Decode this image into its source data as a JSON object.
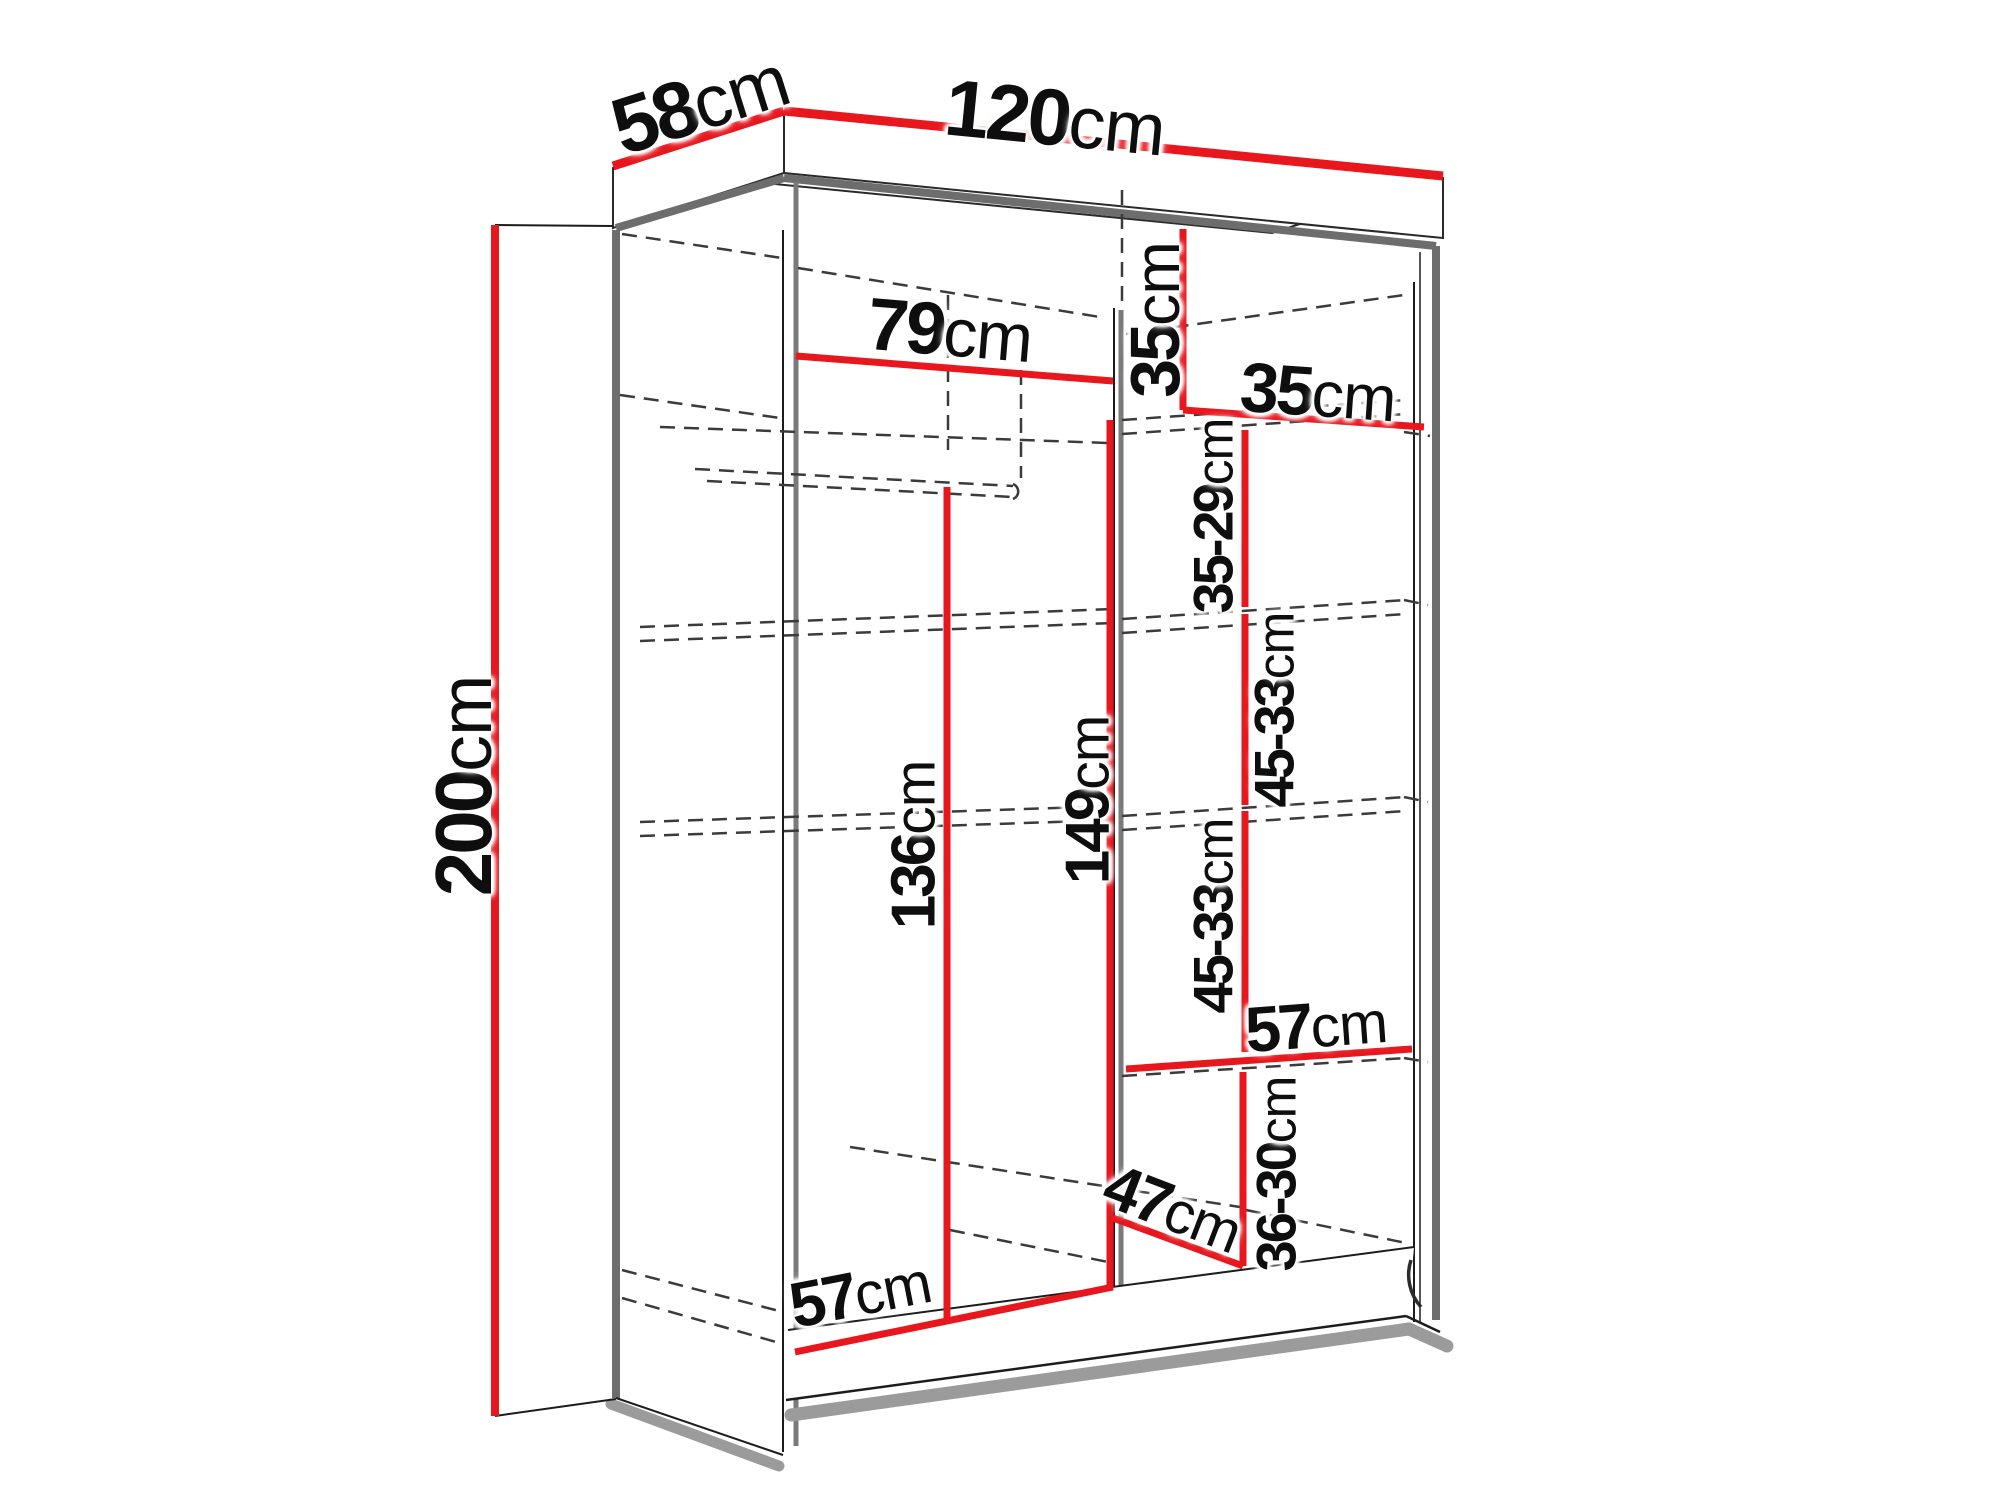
{
  "diagram": {
    "type": "wardrobe-dimension-diagram",
    "unit": "cm",
    "colors": {
      "dimension_line": "#e8161d",
      "structure_line": "#6d6d6d",
      "dashed_line": "#3b3b3b",
      "text": "#0e0e0e"
    },
    "labels": {
      "depth": {
        "value": "58",
        "unit": "cm"
      },
      "width": {
        "value": "120",
        "unit": "cm"
      },
      "height": {
        "value": "200",
        "unit": "cm"
      },
      "left_inner_width": {
        "value": "79",
        "unit": "cm"
      },
      "top_shelf_height": {
        "value": "35",
        "unit": "cm"
      },
      "right_inner_width": {
        "value": "35",
        "unit": "cm"
      },
      "shelf_gap_1": {
        "value": "35-29",
        "unit": "cm"
      },
      "shelf_gap_2": {
        "value": "45-33",
        "unit": "cm"
      },
      "shelf_gap_3": {
        "value": "45-33",
        "unit": "cm"
      },
      "right_shelf_width": {
        "value": "57",
        "unit": "cm"
      },
      "shelf_gap_4": {
        "value": "36-30",
        "unit": "cm"
      },
      "bottom_depth": {
        "value": "47",
        "unit": "cm"
      },
      "partition_height": {
        "value": "149",
        "unit": "cm"
      },
      "hanging_height": {
        "value": "136",
        "unit": "cm"
      },
      "left_bottom_width": {
        "value": "57",
        "unit": "cm"
      }
    }
  }
}
